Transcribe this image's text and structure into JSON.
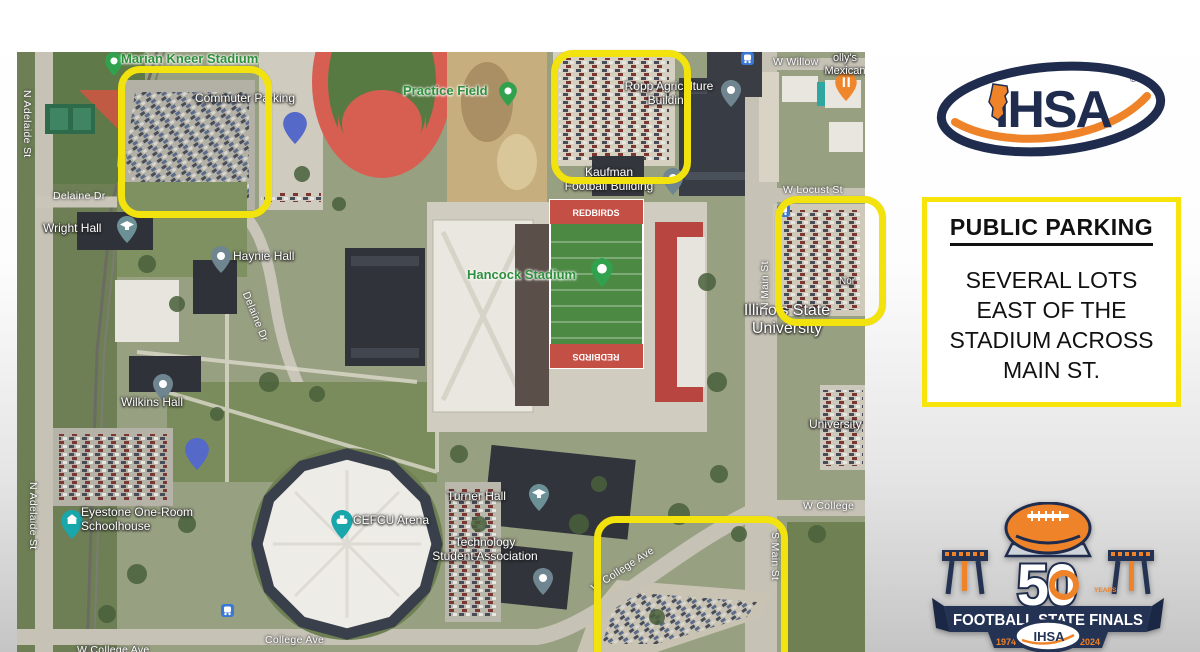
{
  "map": {
    "highlight_color": "#f2e20d",
    "pin_parking_letter": "P",
    "labels": {
      "marian_kneer_stadium": "Marian Kneer Stadium",
      "commuter_parking": "Commuter Parking",
      "practice_field": "Practice Field",
      "ropp_agriculture": "Ropp Agriculture\nBuilding",
      "kaufman_football": "Kaufman\nFootball Building",
      "hancock_stadium": "Hancock Stadium",
      "redbirds": "REDBIRDS",
      "illinois_state_university": "Illinois State\nUniversity",
      "university_partial": "University",
      "north_lot_partial": "Nor",
      "wright_hall": "Wright Hall",
      "haynie_hall": "Haynie Hall",
      "wilkins_hall": "Wilkins Hall",
      "eyestone": "Eyestone One-Room\nSchoolhouse",
      "cefcu_arena": "CEFCU Arena",
      "turner_hall": "Turner Hall",
      "technology_student_association": "Technology\nStudent Association",
      "mexican_restaurant": "olly's\nMexican",
      "streets": {
        "n_adelaide_st": "N Adelaide St",
        "delaine_dr": "Delaine Dr",
        "n_main_st": "N Main St",
        "s_main_st": "S Main St",
        "w_locust_st": "W Locust St",
        "w_willow": "W Willow",
        "w_college": "W College",
        "w_college_ave": "W College Ave",
        "college_ave": "College Ave"
      }
    }
  },
  "ihsa_logo": {
    "text": "IHSA",
    "registered": "®",
    "navy": "#1f2c4e",
    "orange": "#ef8329"
  },
  "parking_panel": {
    "title": "PUBLIC PARKING",
    "body": "SEVERAL LOTS\nEAST OF THE\nSTADIUM ACROSS\nMAIN ST.",
    "border_color": "#f6e40a"
  },
  "anniversary_logo": {
    "number": "50",
    "years_label": "YEARS",
    "banner": "FOOTBALL STATE FINALS",
    "year_start": "1974",
    "year_end": "2024",
    "stars": "★★★★★",
    "brand": "IHSA"
  }
}
